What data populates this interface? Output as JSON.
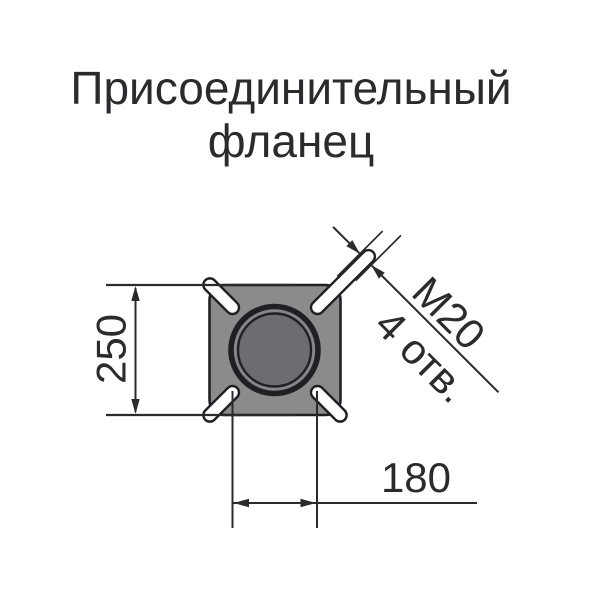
{
  "title": {
    "line1": "Присоединительный",
    "line2": "фланец"
  },
  "dimensions": {
    "height": "250",
    "bolt_spacing": "180",
    "bolt_thread": "М20",
    "bolt_count": "4 отв."
  },
  "colors": {
    "background": "#ffffff",
    "plate_gray": "#8b8b8b",
    "bore_ring_gap_gray": "#85858a",
    "bore_inner_gray": "#6d6d71",
    "outline_dark": "#202024",
    "dimension_line": "#2b2b2e",
    "text": "#2b2b2e",
    "slot_white": "#ffffff"
  }
}
